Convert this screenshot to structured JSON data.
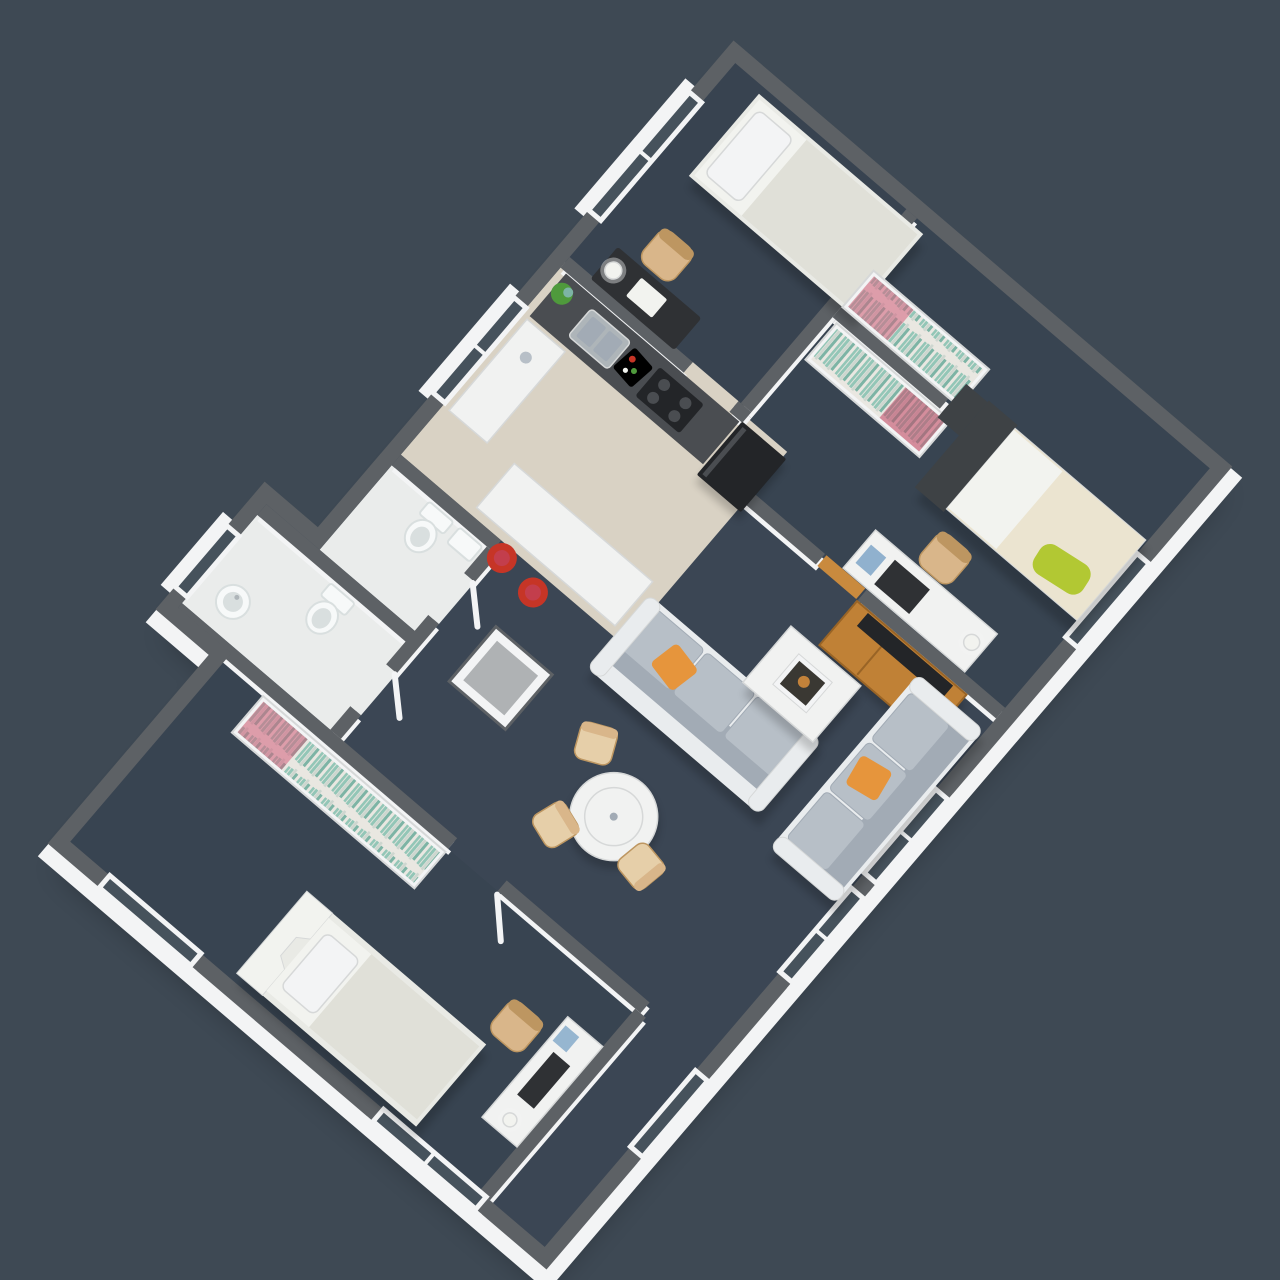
{
  "scene": {
    "type": "isometric 3d floor plan rendering of an apartment",
    "background": "dark slate",
    "plan_rotation_deg": 40.5,
    "walls": "white walls with dark gray tops",
    "no_visible_text": true
  },
  "colors": {
    "bg": "#3e4954",
    "wallTop": "#5d6165",
    "wallFace": "#f3f4f5",
    "roomTint": "#2c3642",
    "carpet": "#3b4654",
    "kitchenFloor": "#d9d2c4",
    "bathFloor": "#eaeceb",
    "woodFloor": "#c98a3e",
    "wood": "#c08136",
    "woodDark": "#996426",
    "sofaFrame": "#e9ecee",
    "sofaCushion": "#b7bfc7",
    "sofaCushionDark": "#a2abb5",
    "pillowOrange": "#e6953c",
    "tableWhite": "#f1f2f1",
    "artDark": "#3a3833",
    "chairTan": "#d9b68a",
    "chairTanDark": "#bd9661",
    "chairBeige": "#e6cfa9",
    "bedWhite": "#e9eae5",
    "bedSheet": "#f2f3ef",
    "bedDuvet": "#e0e0d8",
    "bed2Duvet": "#ebe4d0",
    "headboardDark": "#3e4245",
    "pillowGreen": "#b2c833",
    "bookTeal": "#93c6b7",
    "bookTeal2": "#7db4a5",
    "bookWhite": "#e9e7e1",
    "bookPale": "#cdd6cf",
    "bookPink": "#d4607e",
    "bookPinkDark": "#c24465",
    "appliance": "#232528",
    "counterDark": "#4a4d51",
    "steel": "#aeb5b9",
    "stoolRed": "#c63526",
    "plantGreen": "#4f9a3c",
    "ceramic": "#f7f9f9",
    "ceramicShade": "#d9dfdf",
    "deskDark": "#2f3134",
    "glass": "#46525c",
    "blue": "#7fa6c8",
    "frameLine": "#d6d8d8",
    "shadow": "#000000"
  },
  "rooms": [
    {
      "id": "bedroom-1",
      "label": "bedroom (top)",
      "floor": "dark blue carpet",
      "items": [
        "single bed with white bedding",
        "pillow",
        "dark desk",
        "white table lamp",
        "tan desk chair",
        "bookcase with colorful books",
        "window in west wall"
      ]
    },
    {
      "id": "bedroom-2",
      "label": "bedroom (right)",
      "floor": "dark blue carpet",
      "items": [
        "single bed with dark headboard",
        "cream duvet",
        "lime green cushion",
        "dark nightstand",
        "bookcase with colorful books",
        "white desk",
        "dark monitor",
        "tan desk chair",
        "desk lamp",
        "window in east wall"
      ]
    },
    {
      "id": "living-dining-room",
      "label": "living / dining room",
      "floor": "dark blue carpet",
      "items": [
        "gray sofa",
        "gray corner sofa against window wall",
        "orange cushions",
        "white coffee table",
        "framed print",
        "wooden TV sideboard",
        "television",
        "round white dining table",
        "beige dining chairs",
        "white wardrobe box",
        "two east windows"
      ]
    },
    {
      "id": "kitchen",
      "label": "kitchen",
      "floor": "beige tiles",
      "items": [
        "dark counter with steel sink",
        "black cooktop",
        "tall black fridge unit",
        "white side counter",
        "white breakfast peninsula",
        "two red bar stools",
        "cutting board with food",
        "green plant",
        "window in west wall"
      ]
    },
    {
      "id": "bathroom-1",
      "label": "bathroom (small)",
      "floor": "light tiles",
      "items": [
        "toilet",
        "small vanity"
      ]
    },
    {
      "id": "bathroom-2",
      "label": "bathroom (large)",
      "floor": "light tiles",
      "items": [
        "toilet",
        "round pedestal basin",
        "window in west wing wall"
      ]
    },
    {
      "id": "bedroom-3",
      "label": "bedroom (bottom)",
      "floor": "dark blue carpet",
      "items": [
        "single bed with notched headboard",
        "bookcase with colorful books",
        "white desk with monitor",
        "tan desk chair",
        "south windows",
        "east nook window"
      ]
    }
  ]
}
